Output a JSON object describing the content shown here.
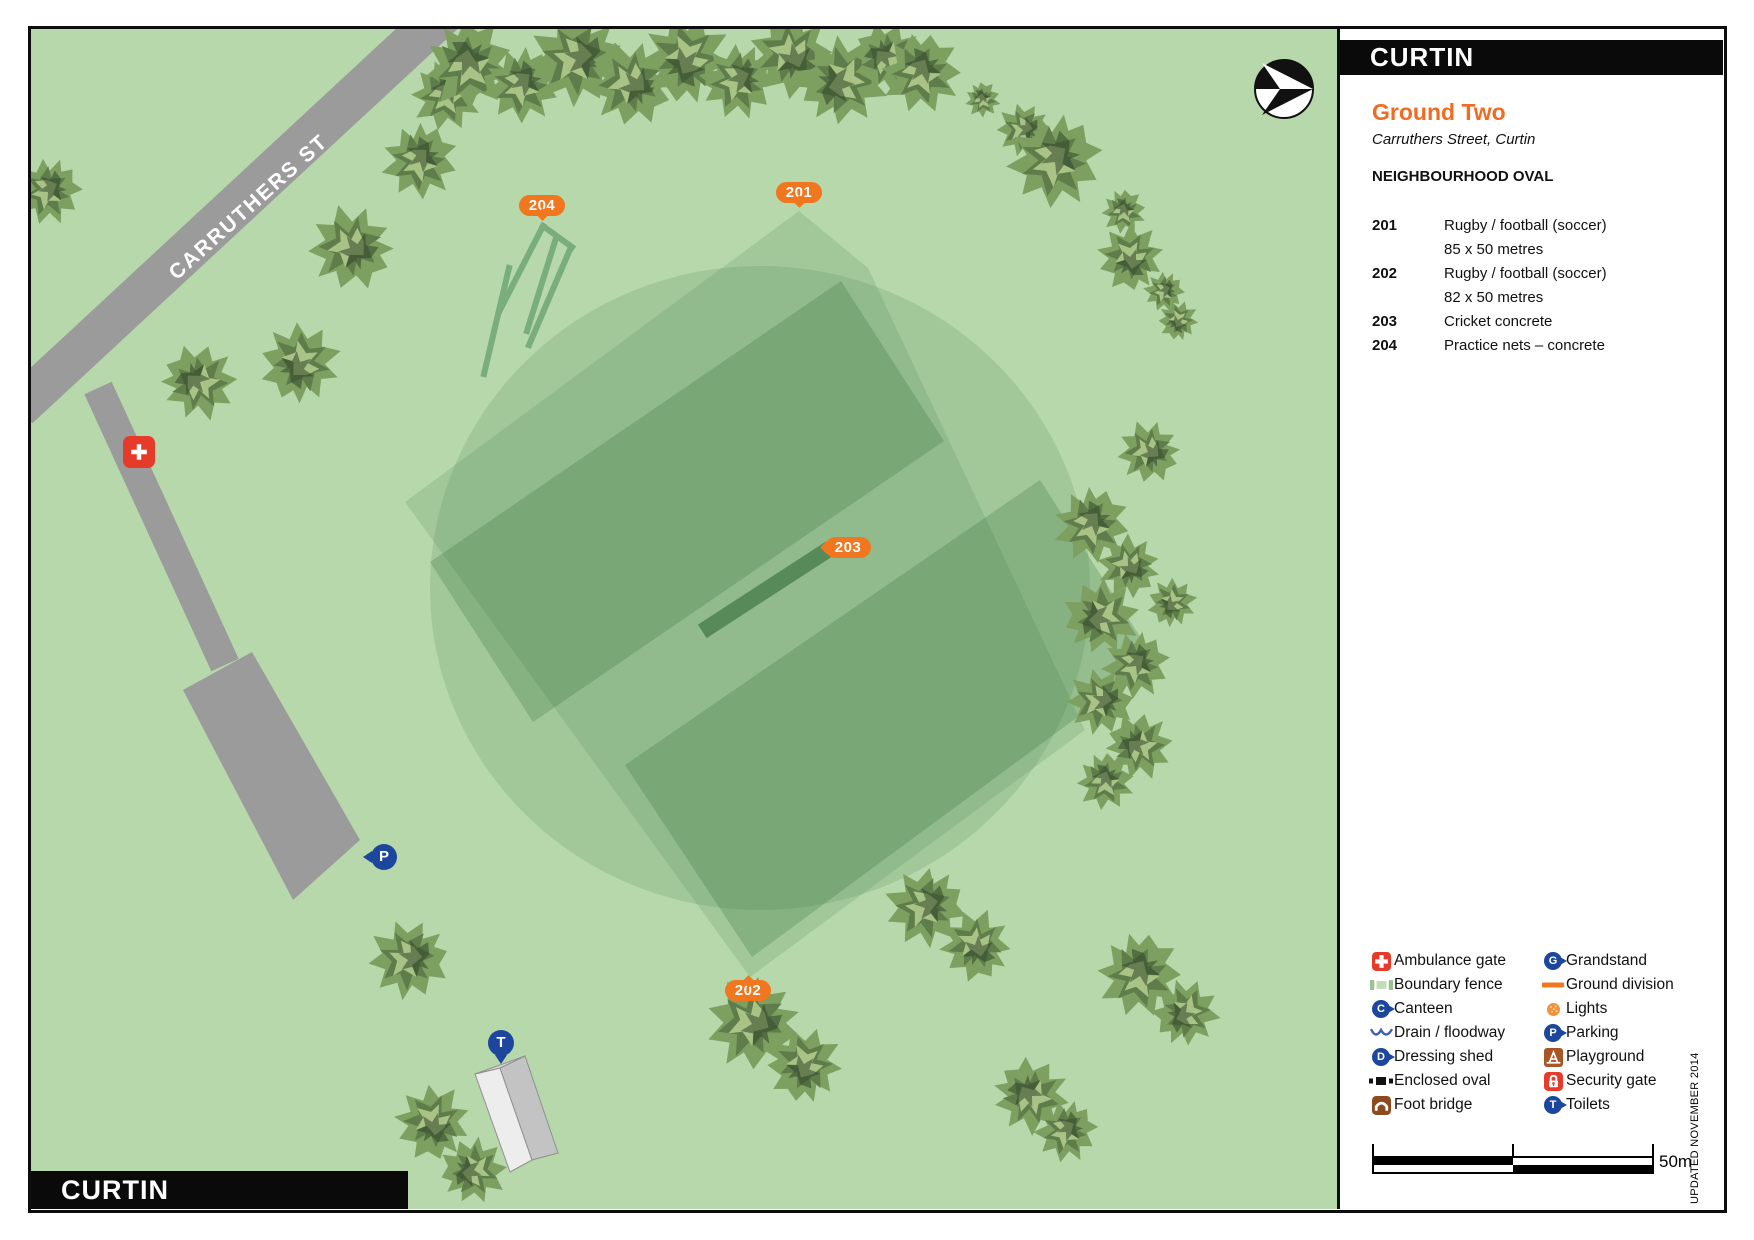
{
  "map": {
    "street_label": "CARRUTHERS ST",
    "corner_label": "CURTIN",
    "markers": [
      {
        "id": "marker-201",
        "label": "201"
      },
      {
        "id": "marker-202",
        "label": "202"
      },
      {
        "id": "marker-203",
        "label": "203"
      },
      {
        "id": "marker-204",
        "label": "204"
      }
    ],
    "pins": {
      "parking_letter": "P",
      "toilets_letter": "T"
    }
  },
  "panel": {
    "title": "CURTIN",
    "ground_title": "Ground Two",
    "address": "Carruthers Street, Curtin",
    "oval_type": "NEIGHBOURHOOD OVAL",
    "facility_lines": [
      {
        "code": "201",
        "text": "Rugby / football (soccer)"
      },
      {
        "code": "",
        "text": "85 x 50 metres"
      },
      {
        "code": "202",
        "text": "Rugby / football (soccer)"
      },
      {
        "code": "",
        "text": "82 x 50 metres"
      },
      {
        "code": "203",
        "text": "Cricket concrete"
      },
      {
        "code": "204",
        "text": "Practice nets – concrete"
      }
    ],
    "legend": {
      "left": [
        {
          "icon": "ambulance-gate-icon",
          "label": "Ambulance gate"
        },
        {
          "icon": "boundary-fence-icon",
          "label": "Boundary fence"
        },
        {
          "icon": "canteen-icon",
          "letter": "C",
          "label": "Canteen"
        },
        {
          "icon": "drain-floodway-icon",
          "label": "Drain / floodway"
        },
        {
          "icon": "dressing-shed-icon",
          "letter": "D",
          "label": "Dressing shed"
        },
        {
          "icon": "enclosed-oval-icon",
          "label": "Enclosed oval"
        },
        {
          "icon": "foot-bridge-icon",
          "label": "Foot bridge"
        }
      ],
      "right": [
        {
          "icon": "grandstand-icon",
          "letter": "G",
          "label": "Grandstand"
        },
        {
          "icon": "ground-division-icon",
          "label": "Ground division"
        },
        {
          "icon": "lights-icon",
          "label": "Lights"
        },
        {
          "icon": "parking-icon",
          "letter": "P",
          "label": "Parking"
        },
        {
          "icon": "playground-icon",
          "label": "Playground"
        },
        {
          "icon": "security-gate-icon",
          "label": "Security gate"
        },
        {
          "icon": "toilets-icon",
          "letter": "T",
          "label": "Toilets"
        }
      ]
    },
    "scale_label": "50m",
    "updated": "UPDATED NOVEMBER 2014"
  },
  "colors": {
    "map_background": "#b6d8ab",
    "ground_overlay": "#46824b",
    "field_overlay": "#235f28",
    "pitch": "#578a58",
    "road": "#9b9b9b",
    "marker_orange": "#f0761f",
    "pin_blue": "#1c479c",
    "alert_red": "#e63b2b",
    "foot_bridge_brown": "#8c4a1f",
    "playground_brown": "#aa5526"
  }
}
